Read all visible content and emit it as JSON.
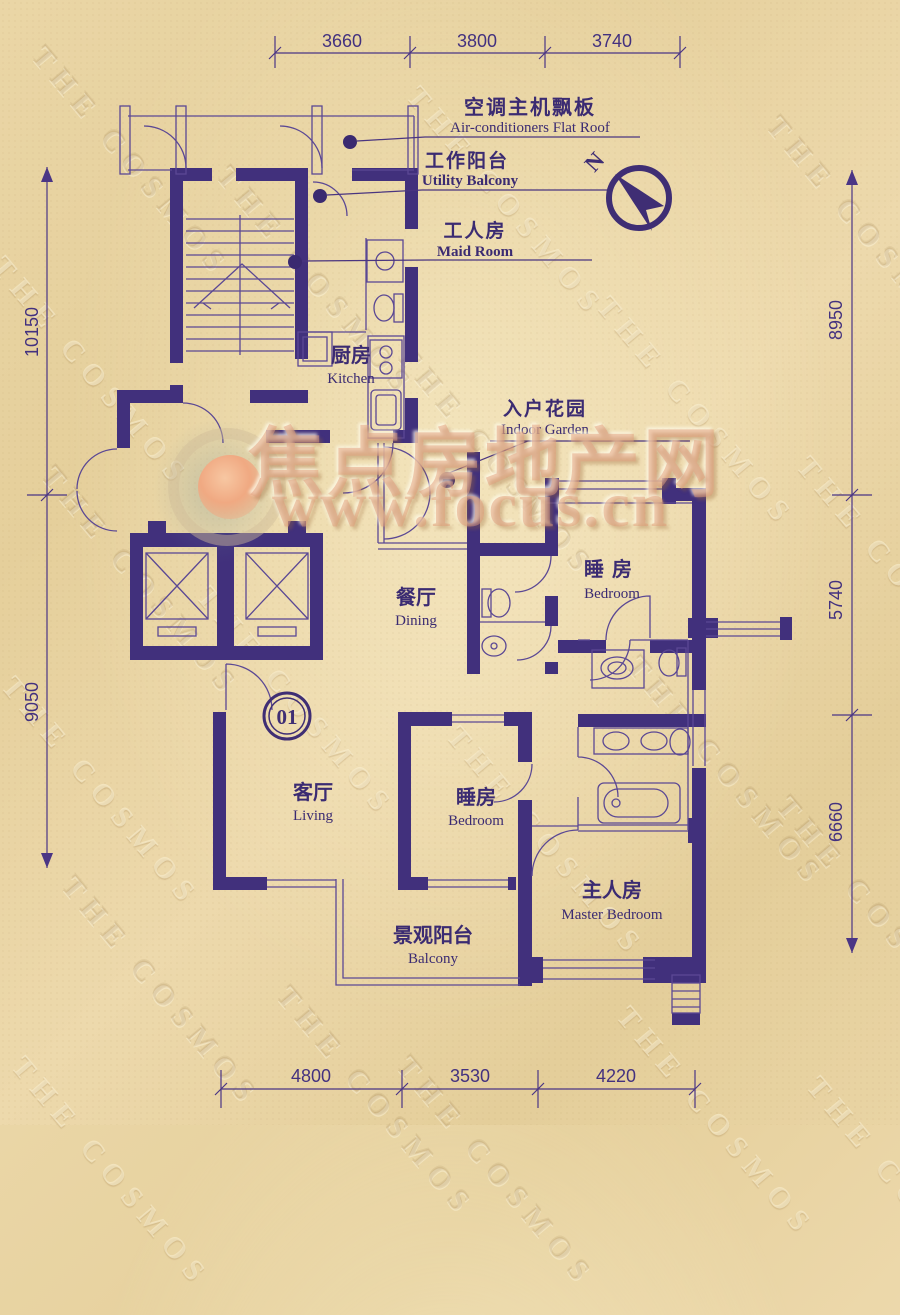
{
  "page": {
    "background_text": "THE COSMOS"
  },
  "brand": {
    "site_zh": "焦点房地产网",
    "site_url": "www.focus.cn"
  },
  "compass": {
    "north_label": "N"
  },
  "unit": {
    "number": "01"
  },
  "annotations": [
    {
      "zh": "空调主机飘板",
      "en": "Air-conditioners Flat Roof"
    },
    {
      "zh": "工作阳台",
      "en": "Utility Balcony"
    },
    {
      "zh": "工人房",
      "en": "Maid Room"
    },
    {
      "zh": "入户花园",
      "en": "Indoor Garden"
    }
  ],
  "rooms": [
    {
      "zh": "厨房",
      "en": "Kitchen"
    },
    {
      "zh": "餐厅",
      "en": "Dining"
    },
    {
      "zh": "睡房",
      "en": "Bedroom"
    },
    {
      "zh": "客厅",
      "en": "Living"
    },
    {
      "zh": "睡房",
      "en": "Bedroom"
    },
    {
      "zh": "主人房",
      "en": "Master Bedroom"
    },
    {
      "zh": "景观阳台",
      "en": "Balcony"
    }
  ],
  "dimensions": {
    "top": [
      "3660",
      "3800",
      "3740"
    ],
    "left": [
      "10150",
      "9050"
    ],
    "right": [
      "8950",
      "5740",
      "6660"
    ],
    "bottom": [
      "4800",
      "3530",
      "4220"
    ]
  }
}
